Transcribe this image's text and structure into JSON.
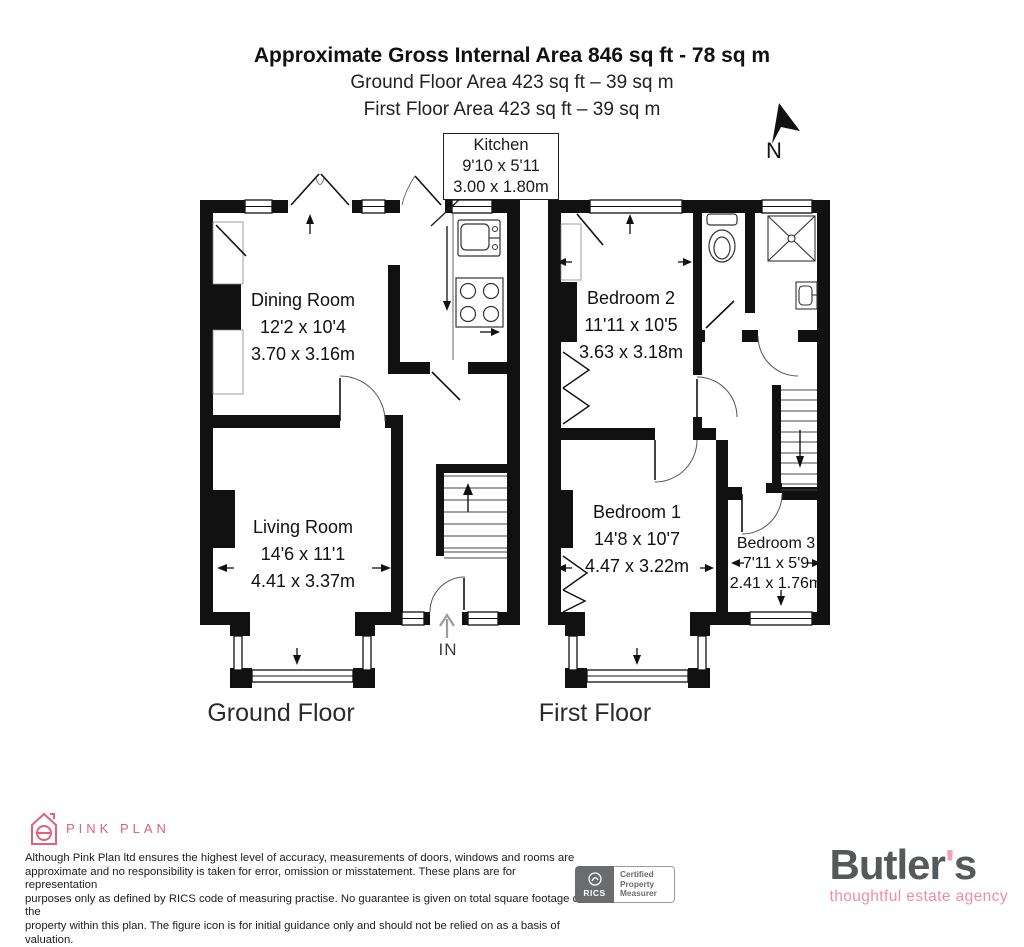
{
  "header": {
    "title": "Approximate Gross Internal Area 846 sq ft - 78 sq m",
    "line2": "Ground Floor Area 423 sq ft – 39 sq m",
    "line3": "First Floor Area 423 sq ft – 39 sq m"
  },
  "compass": {
    "label": "N"
  },
  "kitchen_callout": {
    "name": "Kitchen",
    "imperial": "9'10 x 5'11",
    "metric": "3.00 x 1.80m"
  },
  "ground_floor": {
    "label": "Ground Floor",
    "entrance": "IN",
    "rooms": {
      "dining": {
        "name": "Dining Room",
        "imperial": "12'2 x 10'4",
        "metric": "3.70 x 3.16m"
      },
      "living": {
        "name": "Living Room",
        "imperial": "14'6 x 11'1",
        "metric": "4.41 x 3.37m"
      }
    }
  },
  "first_floor": {
    "label": "First Floor",
    "rooms": {
      "bedroom2": {
        "name": "Bedroom 2",
        "imperial": "11'11 x 10'5",
        "metric": "3.63 x 3.18m"
      },
      "bedroom1": {
        "name": "Bedroom 1",
        "imperial": "14'8 x 10'7",
        "metric": "4.47 x 3.22m"
      },
      "bedroom3": {
        "name": "Bedroom 3",
        "imperial": "7'11 x 5'9",
        "metric": "2.41 x 1.76m"
      }
    }
  },
  "footer": {
    "pink_plan": {
      "name": "PINK PLAN",
      "color": "#e0607e"
    },
    "disclaimer_lines": [
      "Although Pink Plan ltd ensures the highest level of accuracy, measurements of doors, windows and rooms are",
      "approximate and no responsibility is taken for error, omission or misstatement. These plans are for representation",
      "purposes only as defined by RICS code of measuring practise. No guarantee is given on total square footage of the",
      "property within this plan. The figure icon is for initial guidance only and should not be relied on as a basis of valuation."
    ],
    "rics": {
      "org": "RICS",
      "line1": "Certified",
      "line2": "Property",
      "line3": "Measurer"
    },
    "butlers": {
      "name_pre": "Butler",
      "apostrophe": "'",
      "name_post": "s",
      "tagline": "thoughtful estate agency"
    }
  }
}
